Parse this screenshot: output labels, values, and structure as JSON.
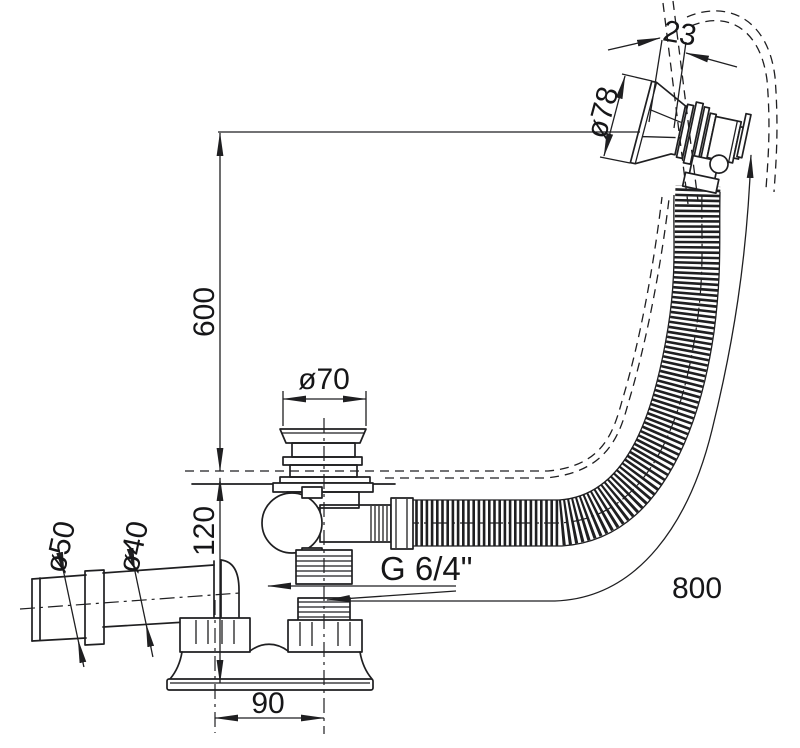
{
  "meta": {
    "type": "technical-drawing",
    "subject": "Bathtub waste and overflow drain set, dimensioned side view",
    "units": "mm"
  },
  "drawing": {
    "background": "#ffffff",
    "line_color": "#1f1f21",
    "dimensions": {
      "head_width": "23",
      "rosette_diameter": "ø78",
      "overflow_height": "600",
      "plug_diameter": "ø70",
      "outlet_outer_diameter": "ø50",
      "outlet_inner_diameter": "ø40",
      "drain_body_height": "120",
      "thread": "G 6/4\"",
      "hose_length": "800",
      "trap_center_offset": "90"
    }
  }
}
